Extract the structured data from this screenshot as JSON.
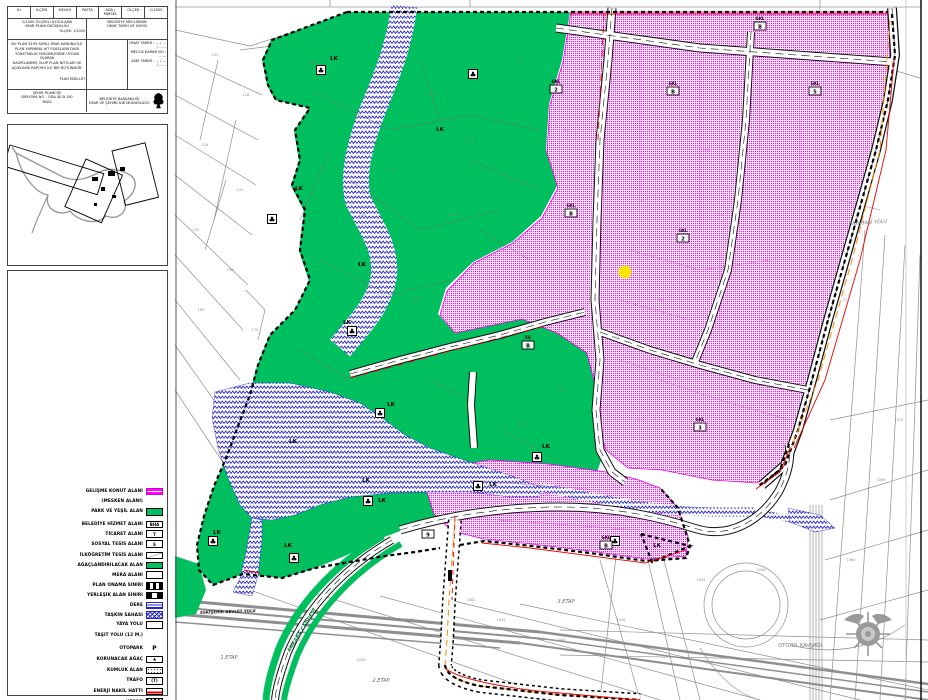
{
  "panel": {
    "title_block": {
      "r1_cells": [
        "İLİ",
        "İLÇESİ",
        "MEVKİİ",
        "PAFTA",
        "ADA / PARSEL",
        "ÖLÇEK",
        "1/1000"
      ],
      "r2_left_lines": [
        "1/1000 ÖLÇEKLİ UYGULAMA",
        "İMAR PLANI DEĞİŞİKLİĞİ"
      ],
      "r2_left_small": "ÖLÇEK: 1/1000",
      "r2_right_lines": [
        "BELEDİYE MECLİSİNİN",
        "ONAY TARİH VE SAYISI"
      ],
      "r3_notes": [
        "BU PLAN 3194 SAYILI İMAR KANUNU İLE",
        "PLAN YAPIMINA AİT ESASLARA DAİR",
        "YÖNETMELİK HÜKÜMLERİNE UYGUN OLARAK",
        "HAZIRLANMIŞ OLUP PLAN NOTLARI VE",
        "AÇIKLAMA RAPORU İLE BİR BÜTÜNDÜR."
      ],
      "r3_note_small": "PLAN MÜELLİFİ",
      "r3_right_lines": [
        "ONAY TARİHİ : ... / ... / ......",
        "MECLİS KARAR NO : ......",
        "ASKI TARİHİ : ... / ... / ......"
      ],
      "r4_left_lines": [
        "ŞEHİR PLANCISI",
        "DİPLOMA NO - ODA SİCİL NO",
        "İMZA"
      ],
      "r4_right_lines": [
        "BELEDİYE BAŞKANLIĞI",
        "İMAR VE ŞEHİRCİLİK MÜDÜRLÜĞÜ"
      ]
    },
    "legend": {
      "items": [
        {
          "label": "GELİŞME KONUT ALANI",
          "swatch": "magenta"
        },
        {
          "label": "(MESKEN ALANI)",
          "swatch": "none"
        },
        {
          "label": "PARK VE YEŞİL ALAN",
          "swatch": "green",
          "gap": 2
        },
        {
          "label": "BELEDİYE HİZMET ALANI",
          "swatch": "boxtext",
          "text": "BHA",
          "gap": 4
        },
        {
          "label": "TİCARET ALANI",
          "swatch": "boxtext",
          "text": "T"
        },
        {
          "label": "SOSYAL TESİS ALANI",
          "swatch": "boxtext",
          "text": "S"
        },
        {
          "label": "İLKÖĞRETİM TESİS ALANI",
          "swatch": "diag",
          "gap": 3
        },
        {
          "label": "AĞAÇLANDIRILACAK ALAN",
          "swatch": "green"
        },
        {
          "label": "MERA ALANI",
          "swatch": "white"
        },
        {
          "label": "PLAN ONAMA SINIRI",
          "swatch": "bwdash",
          "gap": 2
        },
        {
          "label": "YERLEŞİK ALAN SINIRI",
          "swatch": "bwdash2"
        },
        {
          "label": "DERE",
          "swatch": "bluelines"
        },
        {
          "label": "TAŞKIN SAHASI",
          "swatch": "bluehatch"
        },
        {
          "label": "YAYA YOLU",
          "swatch": "white"
        },
        {
          "label": "TAŞIT YOLU (12 M.)",
          "swatch": "none2",
          "gap": 2
        },
        {
          "label": "OTOPARK",
          "swatch": "glyph",
          "text": "P",
          "gap": 4
        },
        {
          "label": "KORUNACAK AĞAÇ",
          "swatch": "tree",
          "text": "♣",
          "gap": 3
        },
        {
          "label": "KUMLUK ALAN",
          "swatch": "dotted",
          "gap": 2
        },
        {
          "label": "TRAFO",
          "swatch": "boxtext",
          "text": "(T)",
          "gap": 2
        },
        {
          "label": "ENERJİ NAKİL HATTI",
          "swatch": "redline",
          "gap": 2
        },
        {
          "label": "KÖPRÜ",
          "swatch": "hatch",
          "gap": 2
        }
      ]
    }
  },
  "map": {
    "colors": {
      "park_green": "#00bf5f",
      "housing_magenta": "#ff00ff",
      "stream_blue": "#2323cc",
      "boundary_black": "#000000",
      "accent_red": "#ee0000",
      "utility_orange": "#ff8c00",
      "poi_yellow": "#ffe600",
      "cadastre_gray": "#8f8f8f"
    },
    "poi_dot": {
      "x": 625,
      "y": 272,
      "r": 6.5,
      "color": "#ffe600"
    },
    "lk_text": "LK",
    "lk_labels": [
      {
        "x": 334,
        "y": 60
      },
      {
        "x": 440,
        "y": 131
      },
      {
        "x": 299,
        "y": 190
      },
      {
        "x": 362,
        "y": 266
      },
      {
        "x": 347,
        "y": 324
      },
      {
        "x": 391,
        "y": 406
      },
      {
        "x": 546,
        "y": 448
      },
      {
        "x": 493,
        "y": 486
      },
      {
        "x": 293,
        "y": 443
      },
      {
        "x": 217,
        "y": 534
      },
      {
        "x": 288,
        "y": 547
      },
      {
        "x": 366,
        "y": 482
      },
      {
        "x": 657,
        "y": 547
      },
      {
        "x": 382,
        "y": 502
      }
    ],
    "tree_icons": [
      {
        "x": 321,
        "y": 70
      },
      {
        "x": 473,
        "y": 74
      },
      {
        "x": 272,
        "y": 219
      },
      {
        "x": 352,
        "y": 331
      },
      {
        "x": 380,
        "y": 413
      },
      {
        "x": 537,
        "y": 457
      },
      {
        "x": 478,
        "y": 486
      },
      {
        "x": 368,
        "y": 501
      },
      {
        "x": 213,
        "y": 541
      },
      {
        "x": 294,
        "y": 558
      },
      {
        "x": 615,
        "y": 541
      }
    ],
    "zone_tags": [
      {
        "x": 760,
        "y": 23,
        "top": "GKL",
        "code": "B"
      },
      {
        "x": 556,
        "y": 86,
        "top": "GKL",
        "code": "2"
      },
      {
        "x": 673,
        "y": 88,
        "top": "GKL",
        "code": "B"
      },
      {
        "x": 815,
        "y": 88,
        "top": "GKL",
        "code": "5"
      },
      {
        "x": 571,
        "y": 210,
        "top": "GKL",
        "code": "B"
      },
      {
        "x": 683,
        "y": 235,
        "top": "GKL",
        "code": "2"
      },
      {
        "x": 528,
        "y": 342,
        "top": "SU",
        "code": "B"
      },
      {
        "x": 700,
        "y": 424,
        "top": "GKL",
        "code": "3"
      },
      {
        "x": 606,
        "y": 542,
        "top": "GKL",
        "code": "B"
      },
      {
        "x": 428,
        "y": 531,
        "top": "",
        "code": "9"
      }
    ],
    "parcel_numbers": [
      {
        "x": 215,
        "y": 56,
        "n": "101"
      },
      {
        "x": 246,
        "y": 96,
        "n": "118"
      },
      {
        "x": 205,
        "y": 146,
        "n": "124"
      },
      {
        "x": 240,
        "y": 191,
        "n": "131"
      },
      {
        "x": 196,
        "y": 231,
        "n": "142"
      },
      {
        "x": 230,
        "y": 271,
        "n": "156"
      },
      {
        "x": 201,
        "y": 311,
        "n": "163"
      },
      {
        "x": 255,
        "y": 331,
        "n": "170"
      },
      {
        "x": 312,
        "y": 64,
        "n": "205"
      },
      {
        "x": 390,
        "y": 171,
        "n": "214"
      },
      {
        "x": 432,
        "y": 96,
        "n": "221"
      },
      {
        "x": 470,
        "y": 141,
        "n": "228"
      },
      {
        "x": 520,
        "y": 62,
        "n": "233"
      },
      {
        "x": 362,
        "y": 216,
        "n": "240"
      },
      {
        "x": 452,
        "y": 216,
        "n": "247"
      },
      {
        "x": 502,
        "y": 251,
        "n": "252"
      },
      {
        "x": 416,
        "y": 301,
        "n": "259"
      },
      {
        "x": 330,
        "y": 431,
        "n": "266"
      },
      {
        "x": 302,
        "y": 461,
        "n": "271"
      },
      {
        "x": 521,
        "y": 426,
        "n": "278"
      },
      {
        "x": 566,
        "y": 131,
        "n": "310"
      },
      {
        "x": 651,
        "y": 131,
        "n": "318"
      },
      {
        "x": 706,
        "y": 151,
        "n": "324"
      },
      {
        "x": 771,
        "y": 121,
        "n": "330"
      },
      {
        "x": 841,
        "y": 131,
        "n": "336"
      },
      {
        "x": 641,
        "y": 201,
        "n": "342"
      },
      {
        "x": 721,
        "y": 216,
        "n": "348"
      },
      {
        "x": 801,
        "y": 231,
        "n": "354"
      },
      {
        "x": 661,
        "y": 301,
        "n": "360"
      },
      {
        "x": 761,
        "y": 321,
        "n": "366"
      },
      {
        "x": 846,
        "y": 301,
        "n": "372"
      },
      {
        "x": 641,
        "y": 421,
        "n": "378"
      },
      {
        "x": 561,
        "y": 391,
        "n": "384"
      },
      {
        "x": 501,
        "y": 521,
        "n": "390"
      },
      {
        "x": 301,
        "y": 641,
        "n": "1021"
      },
      {
        "x": 361,
        "y": 661,
        "n": "1028"
      },
      {
        "x": 501,
        "y": 621,
        "n": "1034"
      },
      {
        "x": 561,
        "y": 641,
        "n": "1040"
      },
      {
        "x": 621,
        "y": 621,
        "n": "1046"
      },
      {
        "x": 701,
        "y": 581,
        "n": "1052"
      },
      {
        "x": 761,
        "y": 571,
        "n": "1058"
      },
      {
        "x": 851,
        "y": 561,
        "n": "1063"
      },
      {
        "x": 881,
        "y": 481,
        "n": "1069"
      },
      {
        "x": 899,
        "y": 421,
        "n": "1075"
      },
      {
        "x": 471,
        "y": 601,
        "n": "1081"
      },
      {
        "x": 411,
        "y": 621,
        "n": "1087"
      }
    ],
    "misc_labels": [
      {
        "x": 868,
        "y": 224,
        "text": "KAYABAŞI YOLU",
        "color": "#777777",
        "size": 5,
        "rot": -4
      },
      {
        "x": 800,
        "y": 647,
        "text": "OTOYOL KAVŞAĞI",
        "color": "#777777",
        "size": 5,
        "rot": 0
      },
      {
        "x": 228,
        "y": 613,
        "text": "ESKİŞEHİR DEVLET YOLU",
        "color": "#1a1a1a",
        "size": 4,
        "rot": -2,
        "bold": true
      },
      {
        "x": 229,
        "y": 659,
        "text": "1.ETAP",
        "color": "#666666",
        "size": 5,
        "rot": 0,
        "italic": true
      },
      {
        "x": 381,
        "y": 682,
        "text": "2.ETAP",
        "color": "#666666",
        "size": 5,
        "rot": 0,
        "italic": true
      },
      {
        "x": 566,
        "y": 603,
        "text": "3.ETAP",
        "color": "#666666",
        "size": 5,
        "rot": 0,
        "italic": true
      },
      {
        "x": 303,
        "y": 631,
        "text": "ANKARA CADDESİ",
        "color": "#007a3d",
        "size": 5,
        "rot": -58,
        "bold": true
      }
    ]
  }
}
